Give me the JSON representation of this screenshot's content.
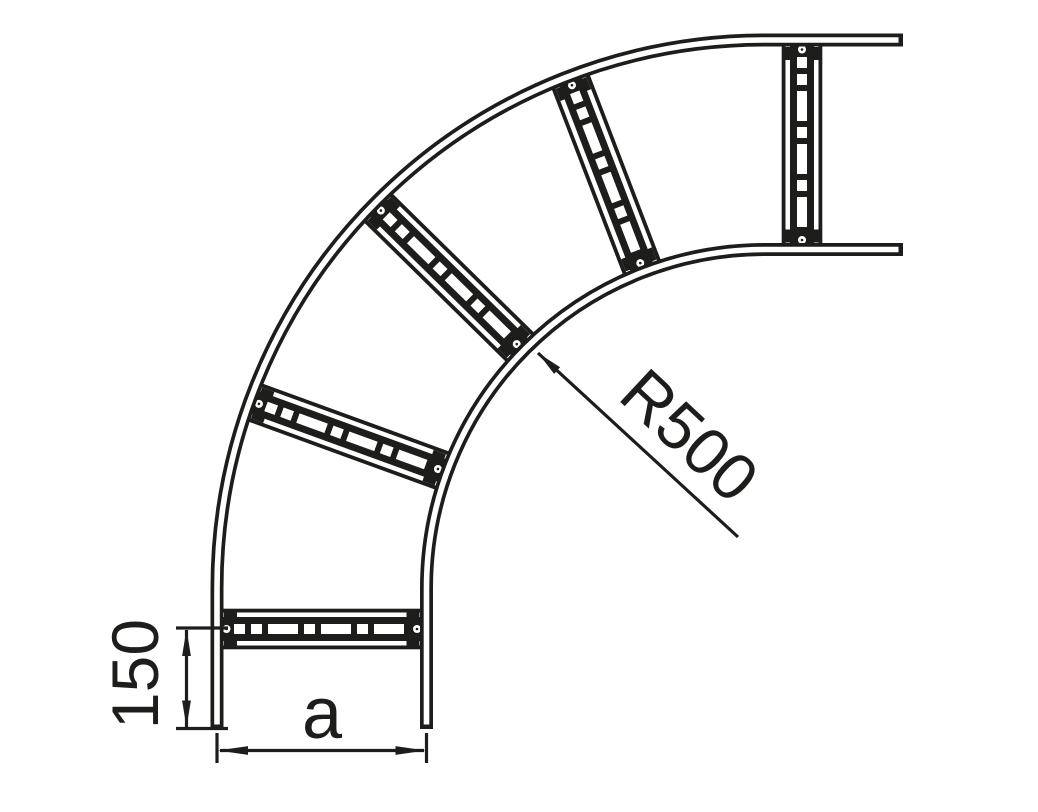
{
  "labels": {
    "radius": "R500",
    "end_offset": "150",
    "width": "a"
  },
  "colors": {
    "line": "#1d1d1b",
    "background": "#ffffff"
  }
}
